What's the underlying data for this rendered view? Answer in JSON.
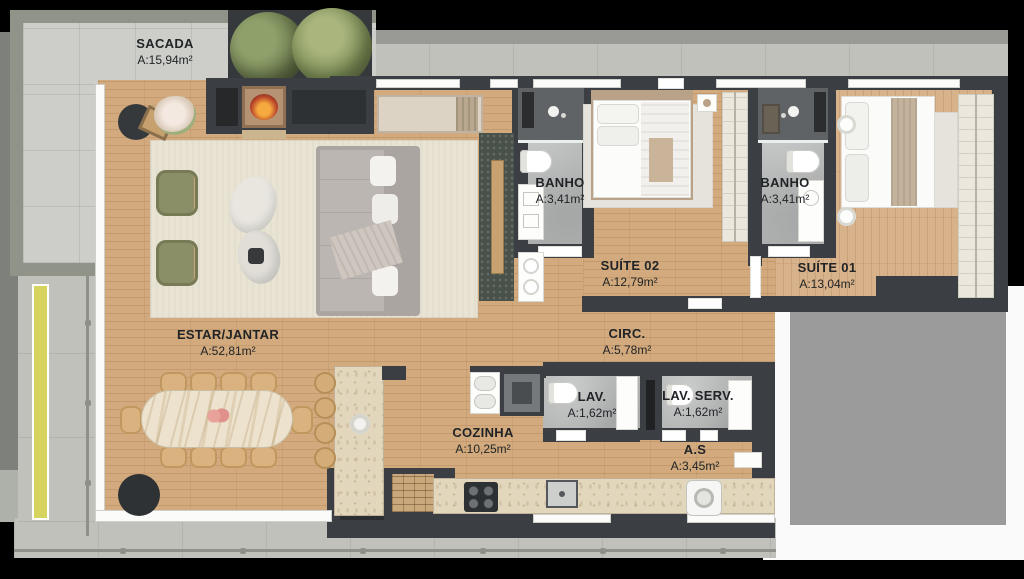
{
  "plan_title": "apartment floor plan",
  "rooms": {
    "sacada": {
      "name": "SACADA",
      "area": "A:15,94m²"
    },
    "banho1": {
      "name": "BANHO",
      "area": "A:3,41m²"
    },
    "suite02": {
      "name": "SUÍTE 02",
      "area": "A:12,79m²"
    },
    "banho2": {
      "name": "BANHO",
      "area": "A:3,41m²"
    },
    "suite01": {
      "name": "SUÍTE 01",
      "area": "A:13,04m²"
    },
    "estar": {
      "name": "ESTAR/JANTAR",
      "area": "A:52,81m²"
    },
    "circ": {
      "name": "CIRC.",
      "area": "A:5,78m²"
    },
    "cozinha": {
      "name": "COZINHA",
      "area": "A:10,25m²"
    },
    "lav": {
      "name": "LAV.",
      "area": "A:1,62m²"
    },
    "lavserv": {
      "name": "LAV. SERV.",
      "area": "A:1,62m²"
    },
    "as": {
      "name": "A.S",
      "area": "A:3,45m²"
    }
  },
  "colors": {
    "background": "#000000",
    "wall": "#3b3e42",
    "wood_floor": "#d2aa7d",
    "balcony_tile": "#cdcec9",
    "concrete": "#c0c1bb",
    "bath_floor": "#b2b5b4",
    "neighbor_mask": "#9b9b9b",
    "label_ink": "#212427",
    "tree_green": "#7d8c5c",
    "accent_yellow": "#d6d45e"
  }
}
